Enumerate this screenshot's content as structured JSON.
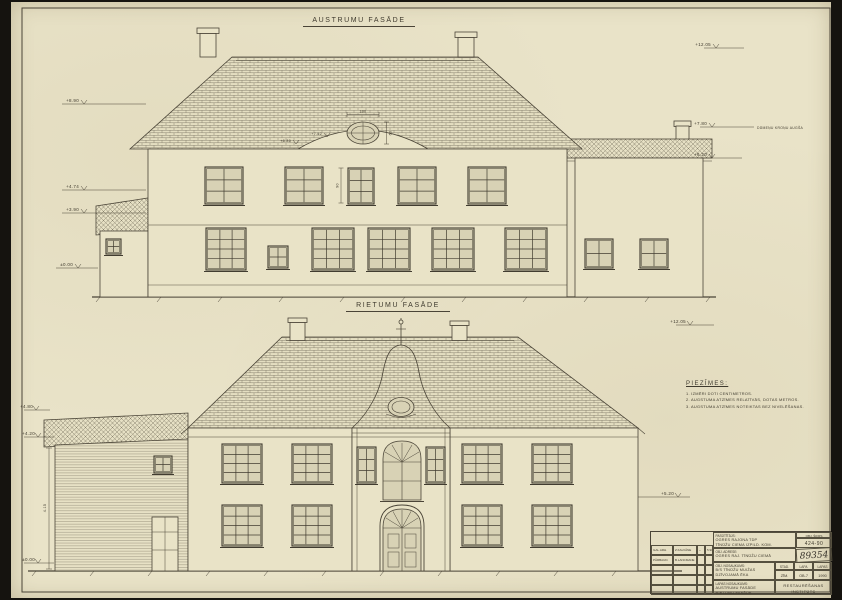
{
  "east": {
    "title": "AUSTRUMU FASĀDE",
    "elev_left": [
      "+8.90",
      "+4.74",
      "+3.90",
      "±0.00"
    ],
    "elev_right": [
      "+12.05",
      "+7.80",
      "+6.20"
    ],
    "elev_right_note": "DŪMEŅU KROŅU AUGŠA",
    "dims": {
      "oval_w": "100",
      "oval_h": "60",
      "win_h": "90",
      "gable1": "+7.52",
      "gable2": "+6.80"
    }
  },
  "west": {
    "title": "RIETUMU FASĀDE",
    "elev_left": [
      "+4.80",
      "+4.20",
      "±0.00"
    ],
    "elev_right": [
      "+12.05",
      "+5.20"
    ],
    "dims": {
      "wing_h": "4.15"
    }
  },
  "notes": {
    "title": "PIEZĪMES:",
    "items": [
      "1. IZMĒRI DOTI CENTIMETROS.",
      "2. AUGSTUMA ATZĪMES RELATĪVĀS, DOTAS METROS.",
      "3. AUGSTUMA ATZĪMES NOTEIKTAS BEZ NIVELĒŠANAS."
    ]
  },
  "titleblock": {
    "customer_label": "PASŪTĪTĀJS:",
    "customer_line1": "OGRES RAJONA TDP",
    "customer_line2": "TĪNŪŽU CIEMA IZPILD. KOM.",
    "code_label": "OBJ. ŠIFRS",
    "code": "424-90",
    "arch_no": "89354",
    "address_label": "OBJ. ADRESE:",
    "address": "OGRES RAJ. TĪNŪŽU CIEMĀ",
    "object_label": "OBJ. NOSAUKUMS:",
    "object_line1": "B/S TĪNŪŽU MUIŽAS",
    "object_line2": "DZĪVOJAMĀ ĒKA",
    "stage_label": "STAD.",
    "sheet_label": "LAPA",
    "sheets_label": "LAPAS",
    "stage": "ZĪM.",
    "sheet_no": "OB-7",
    "sheets": "1990",
    "sheetname_label": "LAPAS NOSAUKUMS:",
    "sheetname_line1": "AUSTRUMU FASĀDE",
    "sheetname_line2": "RIETUMU FASĀDE",
    "org_line1": "RESTAURĒŠANAS",
    "org_line2": "INSTITŪTS",
    "sig_rows": [
      {
        "role": "GAL.ARH.",
        "name": "Z.KALVĀNE",
        "sign": "~",
        "date": "5.90"
      },
      {
        "role": "PĀRBAUD.",
        "name": "B.LANCMANE",
        "sign": "",
        "date": ""
      }
    ]
  }
}
